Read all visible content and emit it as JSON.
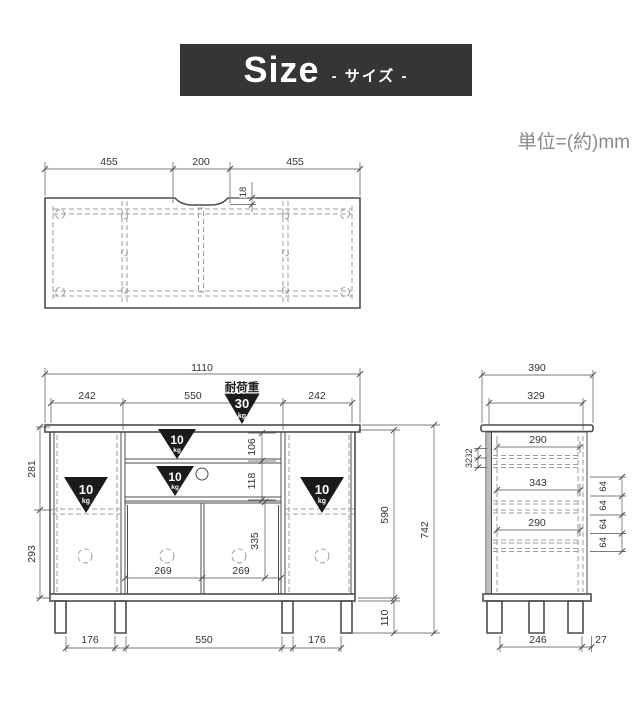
{
  "header": {
    "title": "Size",
    "subtitle": "- サイズ -"
  },
  "unit_note": "単位=(約)mm",
  "colors": {
    "header_bg": "#333537",
    "header_text": "#ffffff",
    "outline": "#4d4d4d",
    "hidden_line": "#9d9d9d",
    "dimension_text": "#333333",
    "load_triangle": "#1b1b1b",
    "unit_text": "#8a8a8a"
  },
  "top_view": {
    "dim_left": "455",
    "dim_center": "200",
    "dim_right": "455",
    "notch_depth": "18"
  },
  "front_view": {
    "total_width": "1110",
    "top_dims": [
      "242",
      "550",
      "242"
    ],
    "load_heading": "耐荷重",
    "top_load_value": "30",
    "top_load_unit": "kg",
    "shelf_load_value": "10",
    "shelf_load_unit": "kg",
    "open_shelf_height": "106",
    "drawer_height": "118",
    "upper_left_height": "281",
    "lower_left_height": "293",
    "door_height": "335",
    "door_widths": [
      "269",
      "269"
    ],
    "body_height": "590",
    "total_height": "742",
    "leg_height": "110",
    "bottom_dims": [
      "176",
      "550",
      "176"
    ]
  },
  "side_view": {
    "total_depth": "390",
    "inner_depth": "329",
    "upper_shelf_depth": "290",
    "back_gaps": [
      "32",
      "32"
    ],
    "inner_width": "343",
    "hole_pitch": [
      "64",
      "64",
      "64",
      "64"
    ],
    "lower_shelf_depth": "290",
    "leg_span": "246",
    "back_offset": "27"
  }
}
